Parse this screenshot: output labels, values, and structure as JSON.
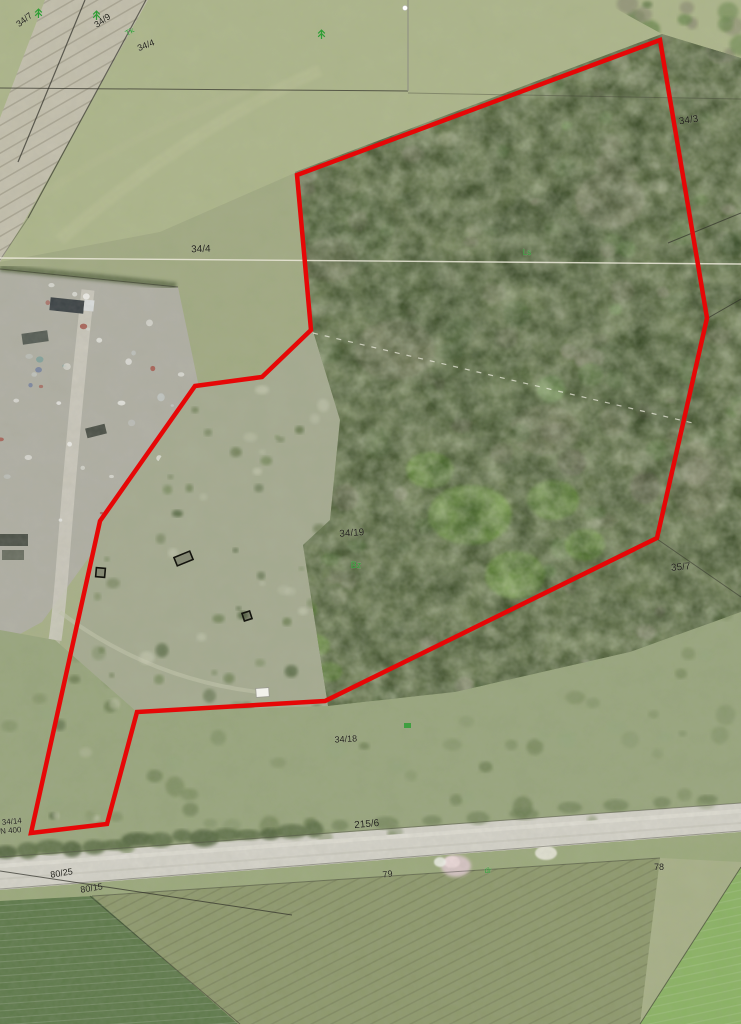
{
  "map": {
    "kind": "aerial-orthophoto-with-cadastral-overlay",
    "width": 741,
    "height": 1024,
    "boundary_color": "#e60707",
    "label_color": "#23231c",
    "landuse_color": "#2f9e35"
  },
  "boundary": {
    "points": "660,40 707,318 657,538 325,701 137,712 107,824 31,833 100,521 195,386 262,377 311,330 297,175",
    "stroke_width": 4.5
  },
  "parcel_labels": [
    {
      "text": "34/7",
      "x": 26,
      "y": 22,
      "rot": -38,
      "size": 9
    },
    {
      "text": "34/9",
      "x": 104,
      "y": 23,
      "rot": -35,
      "size": 9
    },
    {
      "text": "34/4",
      "x": 147,
      "y": 48,
      "rot": -22,
      "size": 9
    },
    {
      "text": "34/4",
      "x": 201,
      "y": 252,
      "rot": -2,
      "size": 10
    },
    {
      "text": "34/3",
      "x": 689,
      "y": 123,
      "rot": -8,
      "size": 10
    },
    {
      "text": "34/19",
      "x": 352,
      "y": 536,
      "rot": -4,
      "size": 10
    },
    {
      "text": "35/7",
      "x": 681,
      "y": 570,
      "rot": -5,
      "size": 10
    },
    {
      "text": "34/18",
      "x": 346,
      "y": 742,
      "rot": -3,
      "size": 9
    },
    {
      "text": "215/6",
      "x": 367,
      "y": 827,
      "rot": -5,
      "size": 10
    },
    {
      "text": "34/14",
      "x": 12,
      "y": 824,
      "rot": -5,
      "size": 8
    },
    {
      "text": "N 400",
      "x": 11,
      "y": 833,
      "rot": -5,
      "size": 8
    },
    {
      "text": "80/25",
      "x": 62,
      "y": 876,
      "rot": -9,
      "size": 9
    },
    {
      "text": "80/15",
      "x": 92,
      "y": 891,
      "rot": -9,
      "size": 9
    },
    {
      "text": "79",
      "x": 388,
      "y": 877,
      "rot": -8,
      "size": 9
    },
    {
      "text": "78",
      "x": 659,
      "y": 870,
      "rot": 0,
      "size": 9
    }
  ],
  "land_use_labels": [
    {
      "text": "Tk",
      "x": 131,
      "y": 34,
      "rot": -30,
      "size": 8
    },
    {
      "text": "Bz",
      "x": 356,
      "y": 568,
      "rot": 0,
      "size": 9
    },
    {
      "text": "Ls",
      "x": 527,
      "y": 255,
      "rot": 0,
      "size": 8
    },
    {
      "text": "dr",
      "x": 488,
      "y": 873,
      "rot": 0,
      "size": 8
    }
  ],
  "tree_symbols": [
    {
      "x": 38,
      "y": 12
    },
    {
      "x": 96,
      "y": 14
    },
    {
      "x": 321,
      "y": 33
    }
  ],
  "building_symbols": [
    {
      "x": 96,
      "y": 568,
      "w": 9,
      "h": 9,
      "rot": 5
    },
    {
      "x": 175,
      "y": 554,
      "w": 17,
      "h": 9,
      "rot": -22
    },
    {
      "x": 243,
      "y": 612,
      "w": 8,
      "h": 8,
      "rot": -18
    }
  ],
  "white_structures": [
    {
      "x": 256,
      "y": 688,
      "w": 13,
      "h": 9,
      "rot": -4
    }
  ],
  "green_patches": [
    {
      "x": 404,
      "y": 723,
      "w": 7,
      "h": 5
    }
  ],
  "survey_points": [
    {
      "x": 405,
      "y": 8,
      "r": 2.5
    }
  ],
  "cadastral_lines": [
    {
      "x1": 0,
      "y1": 88,
      "x2": 408,
      "y2": 91,
      "c": "#3a3a30",
      "w": 1,
      "o": 0.75
    },
    {
      "x1": 408,
      "y1": 93,
      "x2": 741,
      "y2": 99,
      "c": "#3a3a30",
      "w": 1,
      "o": 0.35
    },
    {
      "x1": 408,
      "y1": 0,
      "x2": 408,
      "y2": 91,
      "c": "#8d8d83",
      "w": 1.2,
      "o": 0.8
    },
    {
      "x1": 85,
      "y1": 0,
      "x2": 18,
      "y2": 162,
      "c": "#2f2f28",
      "w": 1.2,
      "o": 0.7
    },
    {
      "x1": 146,
      "y1": 0,
      "x2": 28,
      "y2": 218,
      "c": "#2f2f28",
      "w": 1.2,
      "o": 0.65
    },
    {
      "x1": 28,
      "y1": 218,
      "x2": 0,
      "y2": 260,
      "c": "#2f2f28",
      "w": 1,
      "o": 0.35
    },
    {
      "x1": 0,
      "y1": 258,
      "x2": 741,
      "y2": 264,
      "c": "#ece9da",
      "w": 1.4,
      "o": 0.85
    },
    {
      "x1": 0,
      "y1": 269,
      "x2": 178,
      "y2": 287,
      "c": "#2f2f28",
      "w": 1,
      "o": 0.5
    },
    {
      "x1": 668,
      "y1": 243,
      "x2": 741,
      "y2": 213,
      "c": "#2f2f28",
      "w": 1,
      "o": 0.65
    },
    {
      "x1": 708,
      "y1": 318,
      "x2": 741,
      "y2": 299,
      "c": "#2f2f28",
      "w": 1,
      "o": 0.65
    },
    {
      "x1": 657,
      "y1": 539,
      "x2": 741,
      "y2": 597,
      "c": "#2f2f28",
      "w": 1,
      "o": 0.5
    },
    {
      "x1": 0,
      "y1": 857,
      "x2": 741,
      "y2": 803,
      "c": "#55554a",
      "w": 1,
      "o": 0.5
    },
    {
      "x1": 0,
      "y1": 889,
      "x2": 741,
      "y2": 831,
      "c": "#55554a",
      "w": 1,
      "o": 0.45
    },
    {
      "x1": 0,
      "y1": 871,
      "x2": 292,
      "y2": 915,
      "c": "#2f2f28",
      "w": 1,
      "o": 0.7
    },
    {
      "x1": 90,
      "y1": 896,
      "x2": 240,
      "y2": 1024,
      "c": "#2f2f28",
      "w": 1,
      "o": 0.45
    },
    {
      "x1": 92,
      "y1": 896,
      "x2": 660,
      "y2": 858,
      "c": "#2f2f28",
      "w": 1,
      "o": 0.4
    },
    {
      "x1": 640,
      "y1": 1024,
      "x2": 741,
      "y2": 867,
      "c": "#2f2f28",
      "w": 1,
      "o": 0.55
    },
    {
      "x1": 313,
      "y1": 333,
      "x2": 697,
      "y2": 424,
      "c": "#f2f0e4",
      "w": 1.2,
      "o": 0.7,
      "dash": "5 7"
    }
  ]
}
